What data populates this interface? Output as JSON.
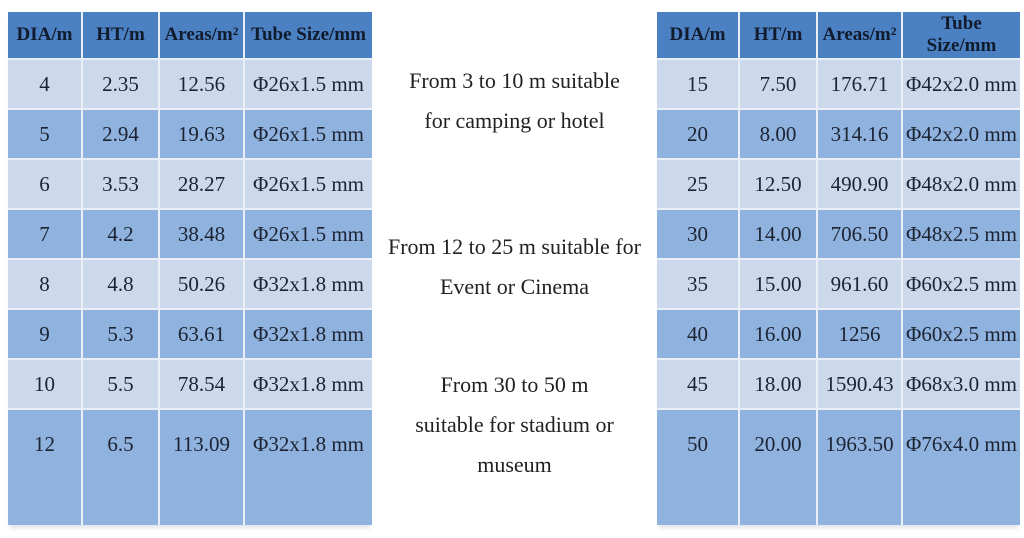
{
  "left_table": {
    "columns": [
      "DIA/m",
      "HT/m",
      "Areas/m²",
      "Tube Size/mm"
    ],
    "rows": [
      [
        "4",
        "2.35",
        "12.56",
        "Φ26x1.5 mm"
      ],
      [
        "5",
        "2.94",
        "19.63",
        "Φ26x1.5 mm"
      ],
      [
        "6",
        "3.53",
        "28.27",
        "Φ26x1.5 mm"
      ],
      [
        "7",
        "4.2",
        "38.48",
        "Φ26x1.5 mm"
      ],
      [
        "8",
        "4.8",
        "50.26",
        "Φ32x1.8 mm"
      ],
      [
        "9",
        "5.3",
        "63.61",
        "Φ32x1.8 mm"
      ],
      [
        "10",
        "5.5",
        "78.54",
        "Φ32x1.8 mm"
      ],
      [
        "12",
        "6.5",
        "113.09",
        "Φ32x1.8 mm"
      ]
    ]
  },
  "right_table": {
    "columns": [
      "DIA/m",
      "HT/m",
      "Areas/m²",
      "Tube Size/mm"
    ],
    "rows": [
      [
        "15",
        "7.50",
        "176.71",
        "Φ42x2.0 mm"
      ],
      [
        "20",
        "8.00",
        "314.16",
        "Φ42x2.0 mm"
      ],
      [
        "25",
        "12.50",
        "490.90",
        "Φ48x2.0 mm"
      ],
      [
        "30",
        "14.00",
        "706.50",
        "Φ48x2.5 mm"
      ],
      [
        "35",
        "15.00",
        "961.60",
        "Φ60x2.5 mm"
      ],
      [
        "40",
        "16.00",
        "1256",
        "Φ60x2.5 mm"
      ],
      [
        "45",
        "18.00",
        "1590.43",
        "Φ68x3.0 mm"
      ],
      [
        "50",
        "20.00",
        "1963.50",
        "Φ76x4.0 mm"
      ]
    ]
  },
  "notes": [
    {
      "lines": [
        "From 3 to 10 m suitable",
        "for camping or hotel"
      ]
    },
    {
      "lines": [
        "From 12 to 25 m suitable for",
        "Event or Cinema"
      ]
    },
    {
      "lines": [
        "From 30 to 50 m",
        "suitable for stadium or",
        "museum"
      ]
    }
  ],
  "colors": {
    "page_bg": "#ffffff",
    "header_bg": "#4b80c2",
    "header_text": "#111b2e",
    "row_light": "#ccd9ed",
    "row_dark": "#8fb2de",
    "grid_line": "#e9eef7",
    "table_text": "#1c2333",
    "note_text": "#212121"
  }
}
